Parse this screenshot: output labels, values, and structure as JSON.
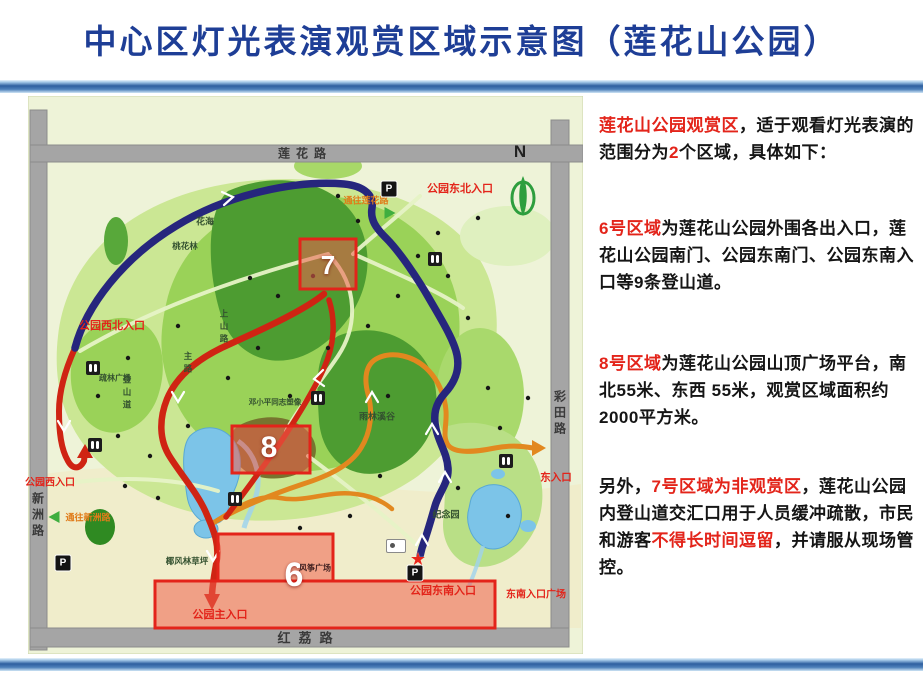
{
  "title": "中心区灯光表演观赏区域示意图（莲花山公园）",
  "colors": {
    "title_blue": "#1e3e96",
    "highlight_red": "#e3241a",
    "bar_blue": "#2e5f9f",
    "route_navy": "#26267d",
    "route_red": "#cf2413",
    "route_orange": "#e2881f",
    "region_fill": "#f1604e",
    "map_background": "#eef3d8"
  },
  "map": {
    "roads": {
      "top": "莲花路",
      "left": "新洲路",
      "right": "彩田路",
      "bottom": "红荔路"
    },
    "compass_n": "N",
    "regions": {
      "r6": "6",
      "r7": "7",
      "r8": "8"
    },
    "entrances": {
      "northeast": "公园东北入口",
      "northwest": "公园西北入口",
      "west": "公园西入口",
      "main": "公园主入口",
      "southeast": "公园东南入口",
      "southeast_plaza": "东南入口广场",
      "east": "东入口"
    },
    "directions": {
      "to_lianhua": "通往莲花路",
      "to_xinzhou": "通往新洲路"
    },
    "pois": {
      "flower_sea": "花海",
      "peach_grove": "桃花林",
      "rainforest_valley": "雨林溪谷",
      "memorial_garden": "纪念园",
      "coconut_lawn": "椰风林草坪",
      "shulin_plaza": "疏林广场",
      "kite_plaza": "风筝广场",
      "deng_statue": "邓小平同志塑像"
    },
    "trails": {
      "shangshan": "上山路",
      "main_road": "主路",
      "dengshan": "登山道"
    },
    "icons": {
      "parking": "P",
      "star": "★"
    }
  },
  "panel": {
    "paragraphs": [
      {
        "segments": [
          {
            "text": "莲花山公园观赏区",
            "red": true
          },
          {
            "text": "，适于观看灯光表演的范围分为"
          },
          {
            "text": "2",
            "red": true
          },
          {
            "text": "个区域，具体如下："
          }
        ]
      },
      {
        "segments": [
          {
            "text": "6号区域",
            "red": true
          },
          {
            "text": "为莲花山公园外围各出入口，莲花山公园南门、公园东南门、公园东南入口等9条登山道。"
          }
        ]
      },
      {
        "segments": [
          {
            "text": "8号区域",
            "red": true
          },
          {
            "text": "为莲花山公园山顶广场平台，南北55米、东西 55米，观赏区域面积约2000平方米。"
          }
        ]
      },
      {
        "segments": [
          {
            "text": "另外，"
          },
          {
            "text": "7号区域为非观赏区",
            "red": true
          },
          {
            "text": "，莲花山公园内登山道交汇口用于人员缓冲疏散，市民和游客"
          },
          {
            "text": "不得长时间逗留",
            "red": true
          },
          {
            "text": "，并请服从现场管控。"
          }
        ]
      }
    ]
  }
}
